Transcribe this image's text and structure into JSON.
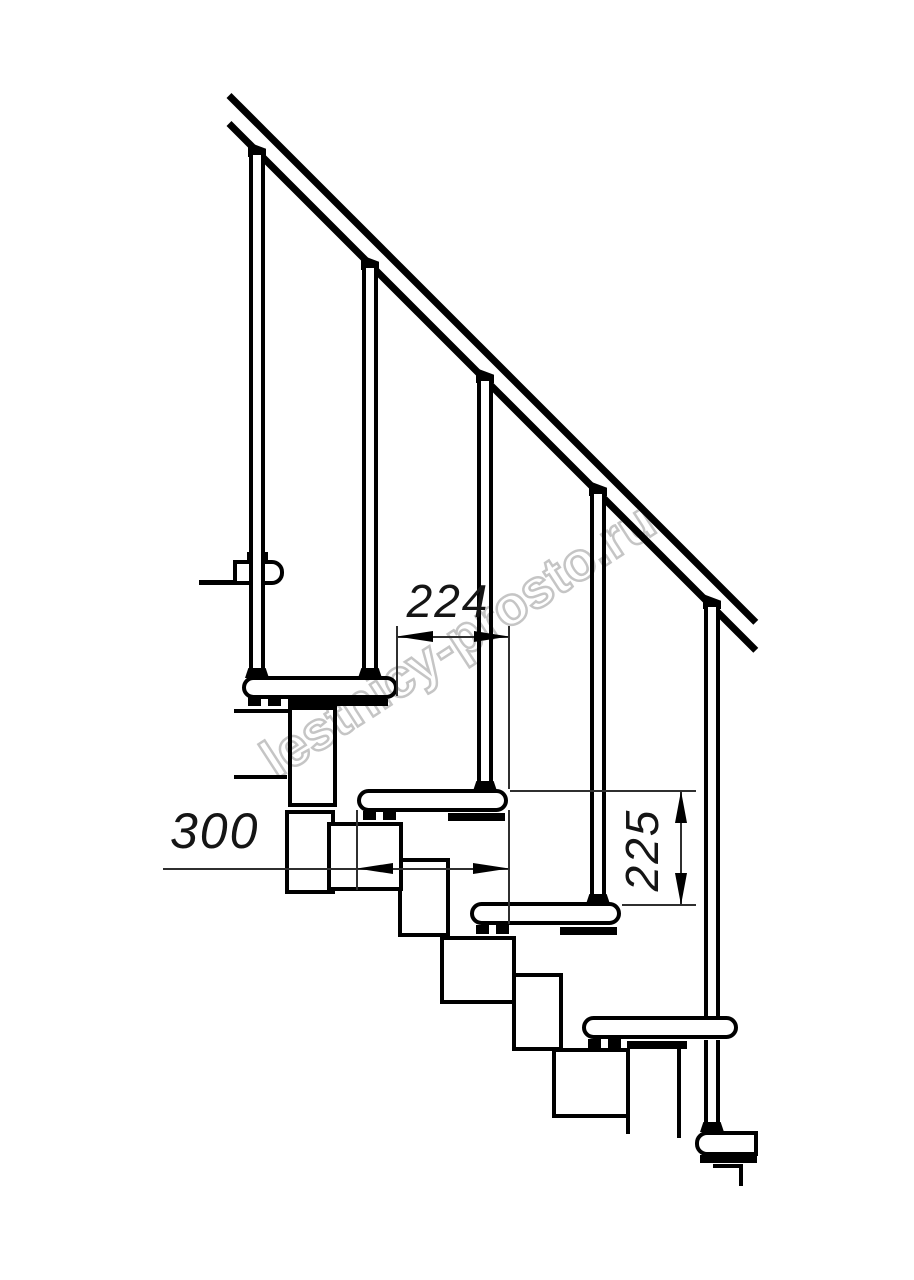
{
  "drawing": {
    "dimensions": {
      "run_between_steps": "224",
      "tread_depth": "300",
      "riser_height": "225"
    },
    "watermark": "lestnicy-prosto.ru"
  }
}
